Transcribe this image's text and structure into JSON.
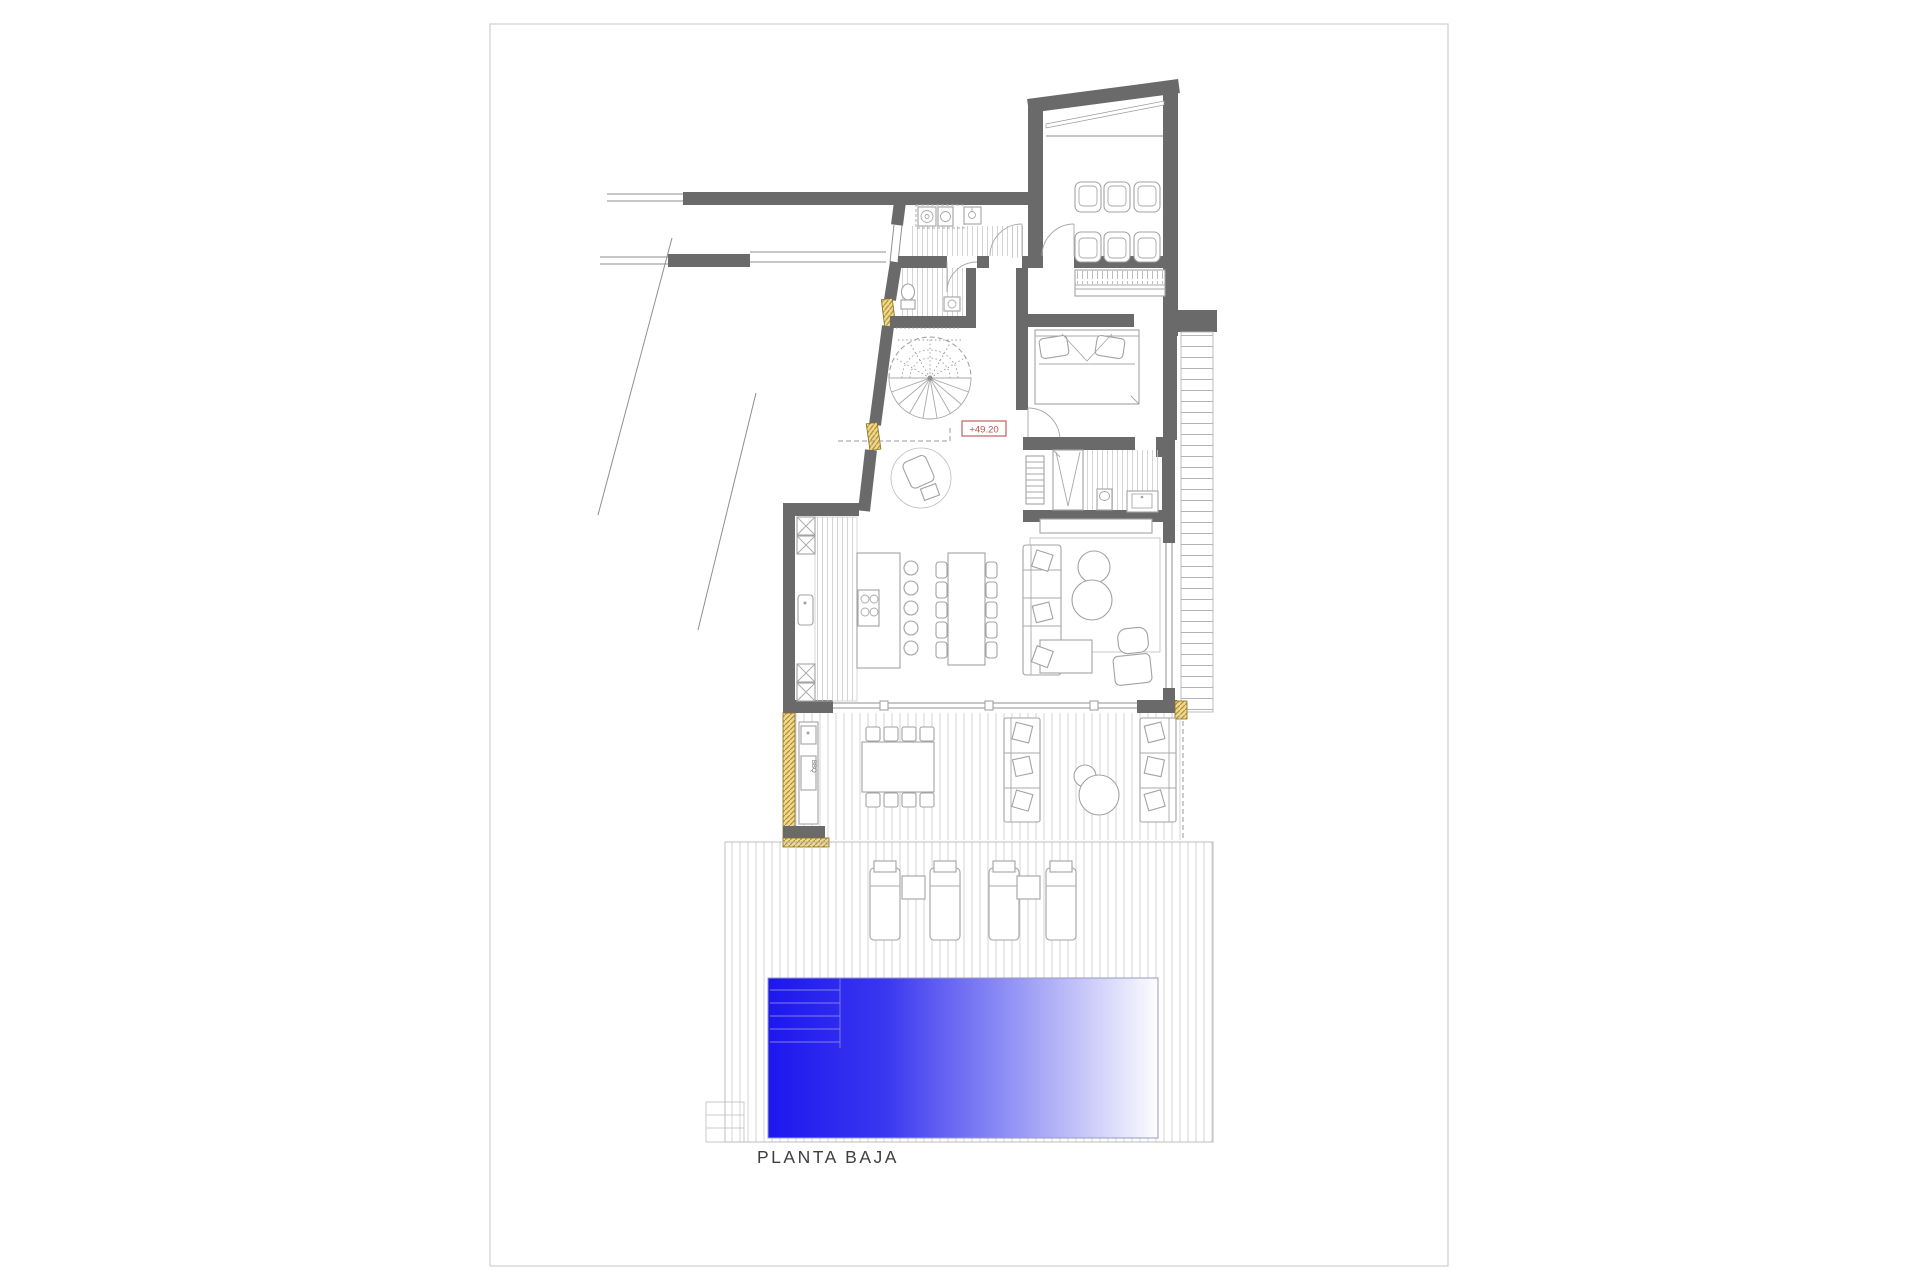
{
  "sheet": {
    "plan_title": "PLANTA BAJA",
    "elevation_marker": "+49.20",
    "bbq_label": "BBQ"
  },
  "colors": {
    "wall_gray": "#6a6a6a",
    "furniture_line": "#a3a3a3",
    "hatch_line": "#c6c6c6",
    "pool_blue": "#1d17ee",
    "window_marker_gold": "#d9b64d",
    "elevation_red": "#c05050",
    "sheet_border": "#cfcfcf",
    "title_text": "#3f3f3f"
  }
}
